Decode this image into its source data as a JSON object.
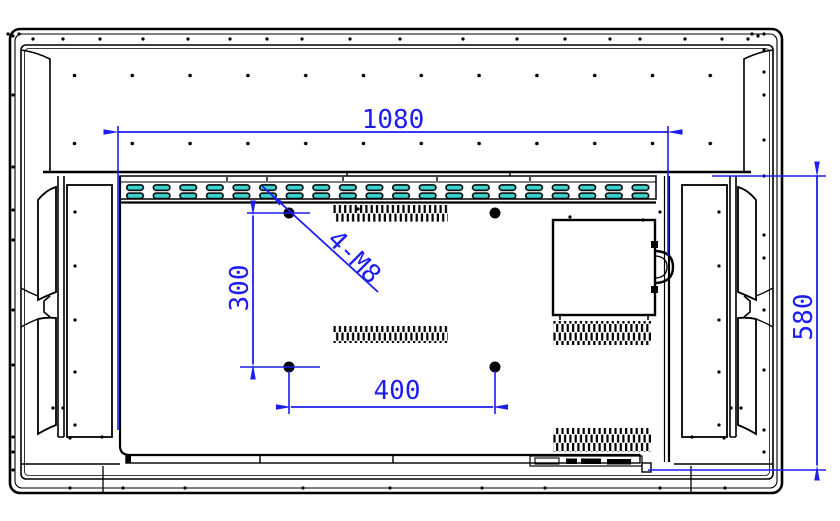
{
  "drawing": {
    "title": "display-rear-view-vesa-dimensions",
    "dimensions": {
      "overall_width": "1080",
      "overall_height": "580",
      "vesa_horizontal": "400",
      "vesa_vertical": "300",
      "mount_holes": "4-M8"
    },
    "colors": {
      "dimension_blue": "#1d1df0",
      "vent_slot_teal": "#3cd2ce",
      "line_black": "#000000",
      "background": "#ffffff"
    }
  }
}
